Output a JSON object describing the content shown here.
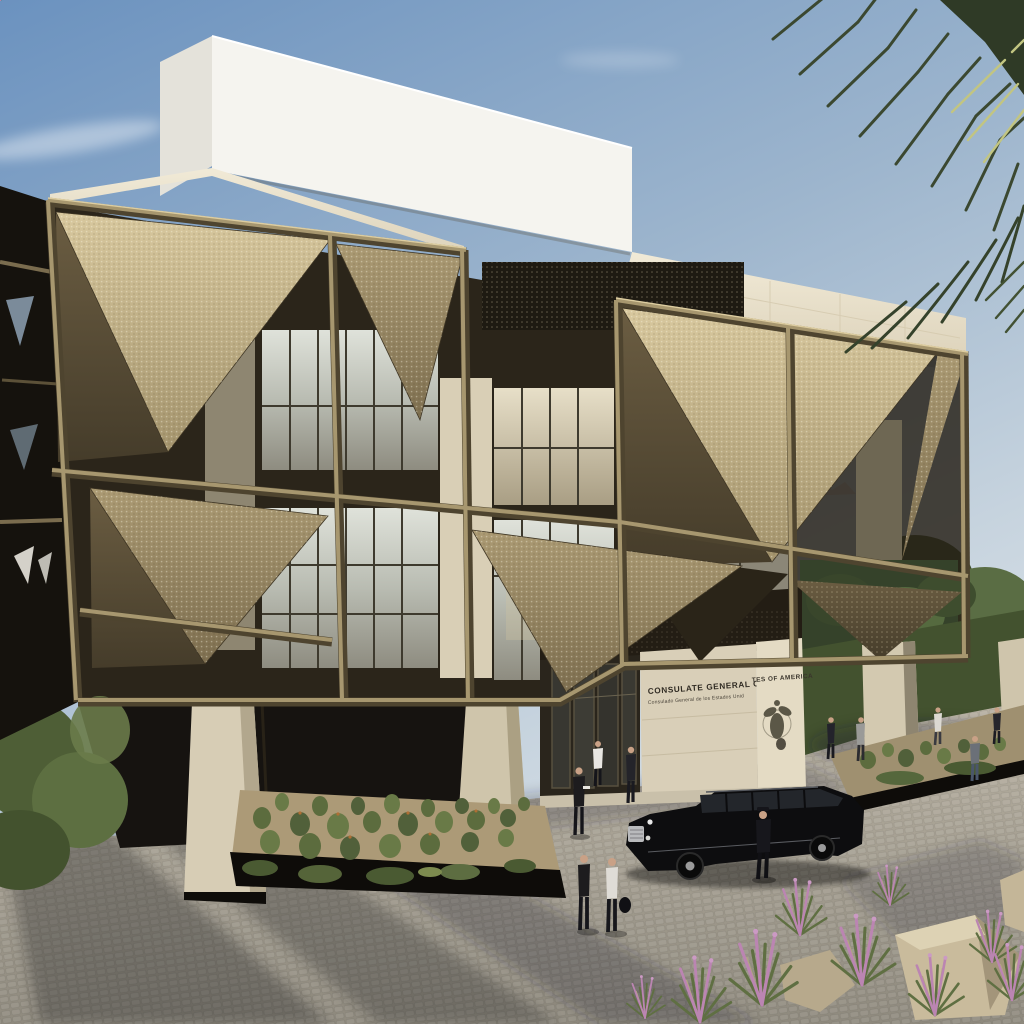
{
  "scene": {
    "description": "Daytime architectural rendering of a U.S. Consulate General: faceted bronze perforated-screen facade over glass and cream stone, white rooftop volume, cobblestone plaza with desert landscaping, black stretch limousine with chauffeur, pedestrians, palm fronds against a blue sky",
    "signage": {
      "line1": "CONSULATE GENERAL OF",
      "line1_continued": "TES OF AMERICA",
      "line2": "Consulado General de los Estados Unid",
      "emblem": "Great Seal of the United States"
    },
    "counts": {
      "pedestrians": 11,
      "vehicles": 1
    },
    "colors": {
      "sky_top": "#6b92bf",
      "sky_horizon": "#dde4ea",
      "white_volume": "#f5f4ef",
      "stone_cream": "#ece3cf",
      "bronze_bright": "#cdbc92",
      "bronze_mid": "#a5946d",
      "bronze_dark": "#5f5239",
      "glass_pale": "#c9cdc5",
      "plaza_gray": "#a8a294",
      "cactus_green": "#5e6e40",
      "foliage_green": "#4b5c36",
      "plume_pink": "#b97fae",
      "limo_black": "#0d0d0f",
      "palm_dark": "#3b4830"
    }
  }
}
